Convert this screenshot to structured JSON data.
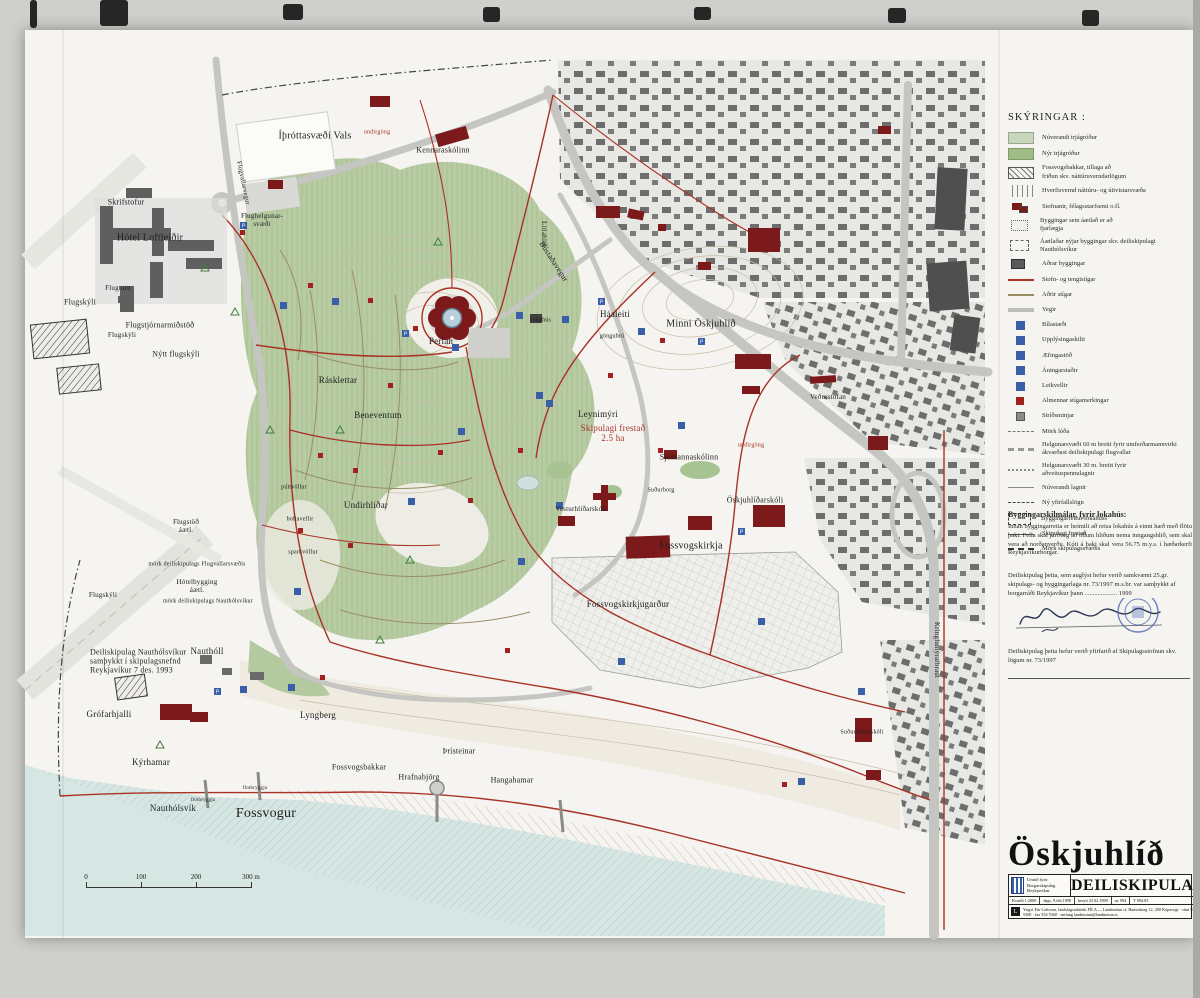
{
  "page": {
    "title": "Öskjuhlíð deiliskipulag – scanned plan sheet"
  },
  "legend": {
    "title": "SKÝRINGAR :",
    "items": [
      {
        "swatch": "veg-existing",
        "label": "Núverandi trjágróður"
      },
      {
        "swatch": "veg-new",
        "label": "Nýr trjágróður"
      },
      {
        "swatch": "hatch-diag",
        "label": "Fossvogsbakkar, tillaga að\nfriðun skv. náttúruverndarlögum"
      },
      {
        "swatch": "hatch-vert",
        "label": "Hverfisvernd náttúru- og útivistarsvæða"
      },
      {
        "swatch": "inst",
        "label": "Stofnanir, félagsstarfsemi o.fl."
      },
      {
        "swatch": "remove",
        "label": "Byggingar sem áætlað er að\nfjarlægja"
      },
      {
        "swatch": "new-bld",
        "label": "Áætlaðar nýjar byggingar skv. deiliskipulagi\nNauthólsvíkur"
      },
      {
        "swatch": "other-bld",
        "label": "Aðrar byggingar"
      },
      {
        "swatch": "red-line",
        "label": "Stofn- og tengistígar"
      },
      {
        "swatch": "brown-line",
        "label": "Aðrir stígar"
      },
      {
        "swatch": "gray-line",
        "label": "Vegir"
      },
      {
        "swatch": "blue-sq",
        "label": "Bílastæði"
      },
      {
        "swatch": "blue-sq",
        "label": "Upplýsingaskilti"
      },
      {
        "swatch": "blue-sq",
        "label": "Æfingastöð"
      },
      {
        "swatch": "blue-sq",
        "label": "Áningarstaðir"
      },
      {
        "swatch": "blue-sq",
        "label": "Leikvellir"
      },
      {
        "swatch": "red-sq",
        "label": "Almennar stígamerkingar"
      },
      {
        "swatch": "gray-sq",
        "label": "Stríðsminjar"
      },
      {
        "swatch": "dashdot-thin",
        "label": "Mörk lóða"
      },
      {
        "swatch": "helg60",
        "label": "Helgunarsvæði 60 m breitt fyrir umferðarmannvirki\nákvarðast deiliskipulagi flugvallar"
      },
      {
        "swatch": "helg30",
        "label": "Helgunarsvæði 30 m. breitt fyrir\naðveituspennulagnir"
      },
      {
        "swatch": "lagnir",
        "label": "Núverandi lagnir"
      },
      {
        "swatch": "yfirfall",
        "label": "Ný yfirfallslögn"
      },
      {
        "swatch": "byggreit",
        "label": "Byggingarreitur lokahúss"
      },
      {
        "swatch": "frestad-line",
        "label": "Skipulagi frestað"
      },
      {
        "swatch": "mork",
        "label": "Mörk skipulagssvæðis"
      }
    ]
  },
  "notes": {
    "skilmalar_title": "Byggingarskilmálar, fyrir lokahús:",
    "skilmalar_body": "Innan byggingarreita er heimilt að reisa lokahús á einni hæð með flötu þaki. Fella skal jarðveg að öllum hliðum nema inngangshlið, sem skal vera að norðanverðu. Kóti á þaki skal vera 56.75 m.y.s. í hæðarkerfi Reykjavíkurborgar.",
    "approval": "Deiliskipulag þetta, sem auglýst hefur verið samkvæmt 25.gr. skipulags- og byggingarlaga nr. 73/1997 m.s.br. var samþykkt af borgarráði Reykjavíkur þann .................... 1999",
    "review": "Deiliskipulag þetta hefur verið yfirfarið af Skipulagsstofnun skv. lögum nr. 73/1997"
  },
  "titleblock": {
    "title": "Öskjuhlíð",
    "subtitle": "DEILISKIPULAG",
    "client": "Unnið fyrir\nBorgarskipulag\nReykjavíkur",
    "scale": "Kvarði 1:2000",
    "date": "dags. 9.feb.1998",
    "revised": "breytt 23.02.1999",
    "number": "nr. 994",
    "drawing": "T 994.03",
    "logo_letter": "L",
    "firm": "Yngvi Þór Loftsson, landslagsarkitekt FÍLA — Landmótun sf, Hamraborg 12, 200 Kópavogi · sími 554 5300 · fax 554 5360 · netfang landmotun@landmotun.is"
  },
  "scalebar": {
    "labels": [
      "0",
      "100",
      "200",
      "300 m"
    ],
    "tick_spacing_px": 55
  },
  "colors": {
    "path_red": "#a93226",
    "institution_red": "#7c191b",
    "vegetation_green": "#b7cca3",
    "sea_blue": "#d6e6e3",
    "icon_blue": "#3a5fa8",
    "stamp_blue": "#4a66b0"
  },
  "map": {
    "labels": [
      {
        "text": "Skrifstofur",
        "x": 126,
        "y": 203,
        "size": 8
      },
      {
        "text": "Hótel Loftleiðir",
        "x": 150,
        "y": 238,
        "size": 10
      },
      {
        "text": "Flugskýli",
        "x": 80,
        "y": 303,
        "size": 8
      },
      {
        "text": "Flugturn",
        "x": 118,
        "y": 289,
        "size": 7
      },
      {
        "text": "Flugstjórnarmiðstöð",
        "x": 160,
        "y": 326,
        "size": 8
      },
      {
        "text": "Flugskýli",
        "x": 122,
        "y": 336,
        "size": 7
      },
      {
        "text": "Nýtt flugskýli",
        "x": 176,
        "y": 355,
        "size": 8
      },
      {
        "text": "Flugstöð\náætl.",
        "x": 186,
        "y": 527,
        "size": 7
      },
      {
        "text": "mörk deiliskipulags Flugvallarsvæðis",
        "x": 197,
        "y": 565,
        "size": 6
      },
      {
        "text": "Hótelbygging\náætl.",
        "x": 197,
        "y": 587,
        "size": 7
      },
      {
        "text": "mörk deiliskipulags Nauthólsvíkur",
        "x": 208,
        "y": 602,
        "size": 6
      },
      {
        "text": "Flugskýli",
        "x": 103,
        "y": 596,
        "size": 7
      },
      {
        "text": "Flughelgunar-\nsvæði",
        "x": 262,
        "y": 221,
        "size": 7
      },
      {
        "text": "Flugvallarvegur",
        "x": 243,
        "y": 183,
        "size": 6.5,
        "rotate": 78
      },
      {
        "text": "Íþróttasvæði Vals",
        "x": 315,
        "y": 136,
        "size": 10
      },
      {
        "text": "undirgöng",
        "x": 377,
        "y": 133,
        "size": 6,
        "color": "#a93226"
      },
      {
        "text": "Kennaraskólinn",
        "x": 443,
        "y": 151,
        "size": 8
      },
      {
        "text": "Litlahlíð",
        "x": 543,
        "y": 234,
        "size": 7,
        "rotate": 90
      },
      {
        "text": "Bústaðavegur",
        "x": 553,
        "y": 262,
        "size": 8,
        "rotate": 57
      },
      {
        "text": "Perlan",
        "x": 441,
        "y": 341,
        "size": 9
      },
      {
        "text": "lokahús",
        "x": 541,
        "y": 321,
        "size": 6
      },
      {
        "text": "Rásklettar",
        "x": 338,
        "y": 380,
        "size": 9
      },
      {
        "text": "Beneventum",
        "x": 378,
        "y": 415,
        "size": 9
      },
      {
        "text": "Undirhlíðar",
        "x": 366,
        "y": 505,
        "size": 9
      },
      {
        "text": "púttvöllur",
        "x": 294,
        "y": 488,
        "size": 6
      },
      {
        "text": "boltavellir",
        "x": 300,
        "y": 520,
        "size": 6
      },
      {
        "text": "sparkvöllur",
        "x": 303,
        "y": 553,
        "size": 6
      },
      {
        "text": "Háaleiti",
        "x": 615,
        "y": 314,
        "size": 9
      },
      {
        "text": "göngubrú",
        "x": 612,
        "y": 337,
        "size": 6
      },
      {
        "text": "Minni Öskjuhlíð",
        "x": 701,
        "y": 324,
        "size": 10
      },
      {
        "text": "Veðurstofan",
        "x": 828,
        "y": 398,
        "size": 7
      },
      {
        "text": "Leynimýri",
        "x": 598,
        "y": 414,
        "size": 9
      },
      {
        "text": "Skipulagi frestað\n2.5 ha",
        "x": 613,
        "y": 433,
        "size": 9,
        "color": "#a9332a"
      },
      {
        "text": "Sjómannaskólinn",
        "x": 689,
        "y": 458,
        "size": 8
      },
      {
        "text": "undirgöng",
        "x": 751,
        "y": 446,
        "size": 6,
        "color": "#a93226"
      },
      {
        "text": "Suðurborg",
        "x": 661,
        "y": 491,
        "size": 6
      },
      {
        "text": "Öskjuhlíðarskóli",
        "x": 755,
        "y": 501,
        "size": 8
      },
      {
        "text": "Vesturhlíðarskóli",
        "x": 581,
        "y": 510,
        "size": 7
      },
      {
        "text": "Fossvogskirkja",
        "x": 691,
        "y": 546,
        "size": 10
      },
      {
        "text": "Fossvogskirkjugarður",
        "x": 628,
        "y": 604,
        "size": 9
      },
      {
        "text": "Deiliskipulag Nauthólsvíkur\nsamþykkt í skipulagsnefnd\nReykjavíkur 7 des. 1993",
        "x": 90,
        "y": 662,
        "size": 8,
        "align": "left"
      },
      {
        "text": "Nauthóll",
        "x": 207,
        "y": 651,
        "size": 9
      },
      {
        "text": "Grófarhjalli",
        "x": 109,
        "y": 714,
        "size": 9
      },
      {
        "text": "Lyngberg",
        "x": 318,
        "y": 715,
        "size": 9
      },
      {
        "text": "Kýrhamar",
        "x": 151,
        "y": 762,
        "size": 9
      },
      {
        "text": "Nauthólsvík",
        "x": 173,
        "y": 808,
        "size": 9
      },
      {
        "text": "Fossvogur",
        "x": 266,
        "y": 814,
        "size": 14
      },
      {
        "text": "Fossvogsbakkar",
        "x": 359,
        "y": 768,
        "size": 8
      },
      {
        "text": "Hrafnabjörg",
        "x": 419,
        "y": 778,
        "size": 8
      },
      {
        "text": "Þrísteinar",
        "x": 459,
        "y": 752,
        "size": 8
      },
      {
        "text": "Hangahamar",
        "x": 512,
        "y": 781,
        "size": 8
      },
      {
        "text": "Suðurhlíðarskóli",
        "x": 862,
        "y": 733,
        "size": 6
      },
      {
        "text": "flotbryggja",
        "x": 203,
        "y": 801,
        "size": 5
      },
      {
        "text": "flotbryggja",
        "x": 255,
        "y": 789,
        "size": 5
      },
      {
        "text": "Kringlumýrarbraut",
        "x": 936,
        "y": 650,
        "size": 7,
        "rotate": 90
      }
    ]
  }
}
